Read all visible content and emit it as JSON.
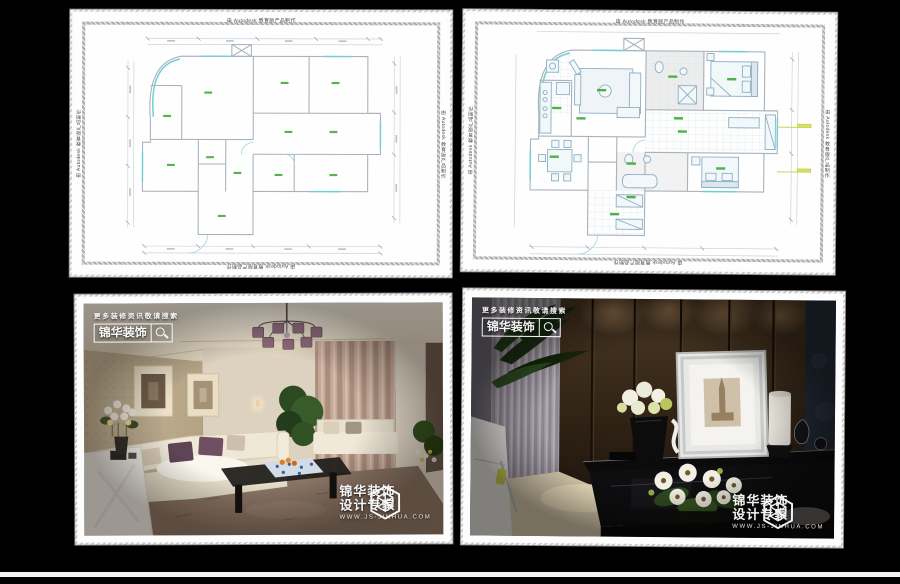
{
  "page": {
    "background": "#000000",
    "bottom_strip_color": "#f2f2f2"
  },
  "cad": {
    "watermark": "由 Autodesk 教育版产品制作",
    "wall_color": "#a9b3bc",
    "window_color": "#76cdd5",
    "label_color": "#55b54a"
  },
  "branding": {
    "search_hint": "更多装修资讯敬请搜索",
    "brand_name": "锦华装饰",
    "tagline": "设计专家",
    "website": "WWW.JS-JINHUA.COM",
    "icons": {
      "search": "magnifier-icon",
      "logo": "hexagon-emblem-icon"
    }
  },
  "panels": [
    {
      "id": "floor-plan-original",
      "type": "cad-drawing"
    },
    {
      "id": "floor-plan-furnished",
      "type": "cad-drawing"
    },
    {
      "id": "living-room-photo",
      "type": "photo"
    },
    {
      "id": "tv-wall-photo",
      "type": "photo"
    }
  ]
}
